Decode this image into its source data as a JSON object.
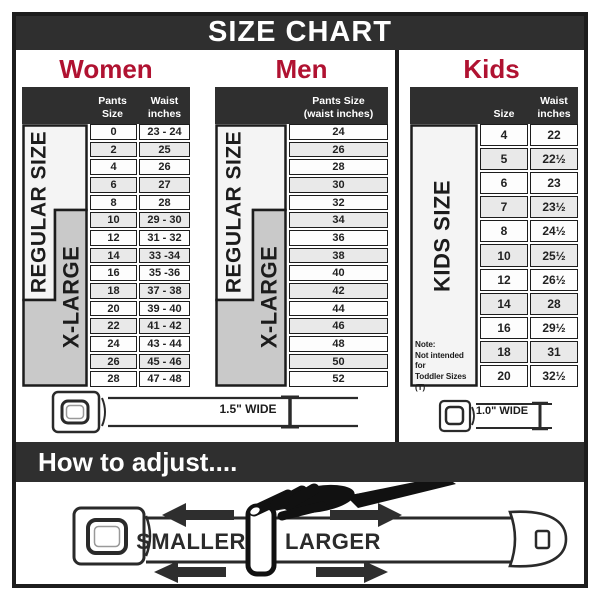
{
  "title": "SIZE CHART",
  "colors": {
    "accent": "#b01231",
    "dark": "#2f2f2f",
    "gray_band": "#c9c9c9",
    "row_alt": "#e9e9e9"
  },
  "chart_data": [
    {
      "type": "table",
      "title": "Women",
      "headers": [
        "Pants Size",
        "Waist\ninches"
      ],
      "regular_label": "REGULAR SIZE",
      "xlarge_label": "X-LARGE",
      "rows": [
        [
          "0",
          "23 - 24"
        ],
        [
          "2",
          "25"
        ],
        [
          "4",
          "26"
        ],
        [
          "6",
          "27"
        ],
        [
          "8",
          "28"
        ],
        [
          "10",
          "29 - 30"
        ],
        [
          "12",
          "31 - 32"
        ],
        [
          "14",
          "33 -34"
        ],
        [
          "16",
          "35 -36"
        ],
        [
          "18",
          "37 - 38"
        ],
        [
          "20",
          "39 - 40"
        ],
        [
          "22",
          "41 - 42"
        ],
        [
          "24",
          "43 - 44"
        ],
        [
          "26",
          "45 - 46"
        ],
        [
          "28",
          "47 - 48"
        ]
      ]
    },
    {
      "type": "table",
      "title": "Men",
      "headers": [
        "Pants Size\n(waist inches)"
      ],
      "regular_label": "REGULAR SIZE",
      "xlarge_label": "X-LARGE",
      "rows": [
        [
          "24"
        ],
        [
          "26"
        ],
        [
          "28"
        ],
        [
          "30"
        ],
        [
          "32"
        ],
        [
          "34"
        ],
        [
          "36"
        ],
        [
          "38"
        ],
        [
          "40"
        ],
        [
          "42"
        ],
        [
          "44"
        ],
        [
          "46"
        ],
        [
          "48"
        ],
        [
          "50"
        ],
        [
          "52"
        ]
      ]
    },
    {
      "type": "table",
      "title": "Kids",
      "headers": [
        "Size",
        "Waist\ninches"
      ],
      "side_label": "KIDS SIZE",
      "note": "Note:\nNot intended for\nToddler Sizes (T)",
      "rows": [
        [
          "4",
          "22"
        ],
        [
          "5",
          "22½"
        ],
        [
          "6",
          "23"
        ],
        [
          "7",
          "23½"
        ],
        [
          "8",
          "24½"
        ],
        [
          "10",
          "25½"
        ],
        [
          "12",
          "26½"
        ],
        [
          "14",
          "28"
        ],
        [
          "16",
          "29½"
        ],
        [
          "18",
          "31"
        ],
        [
          "20",
          "32½"
        ]
      ]
    }
  ],
  "belts": {
    "adult": "1.5\" WIDE",
    "kids": "1.0\" WIDE"
  },
  "adjust": {
    "heading": "How to adjust....",
    "smaller": "SMALLER",
    "larger": "LARGER"
  }
}
